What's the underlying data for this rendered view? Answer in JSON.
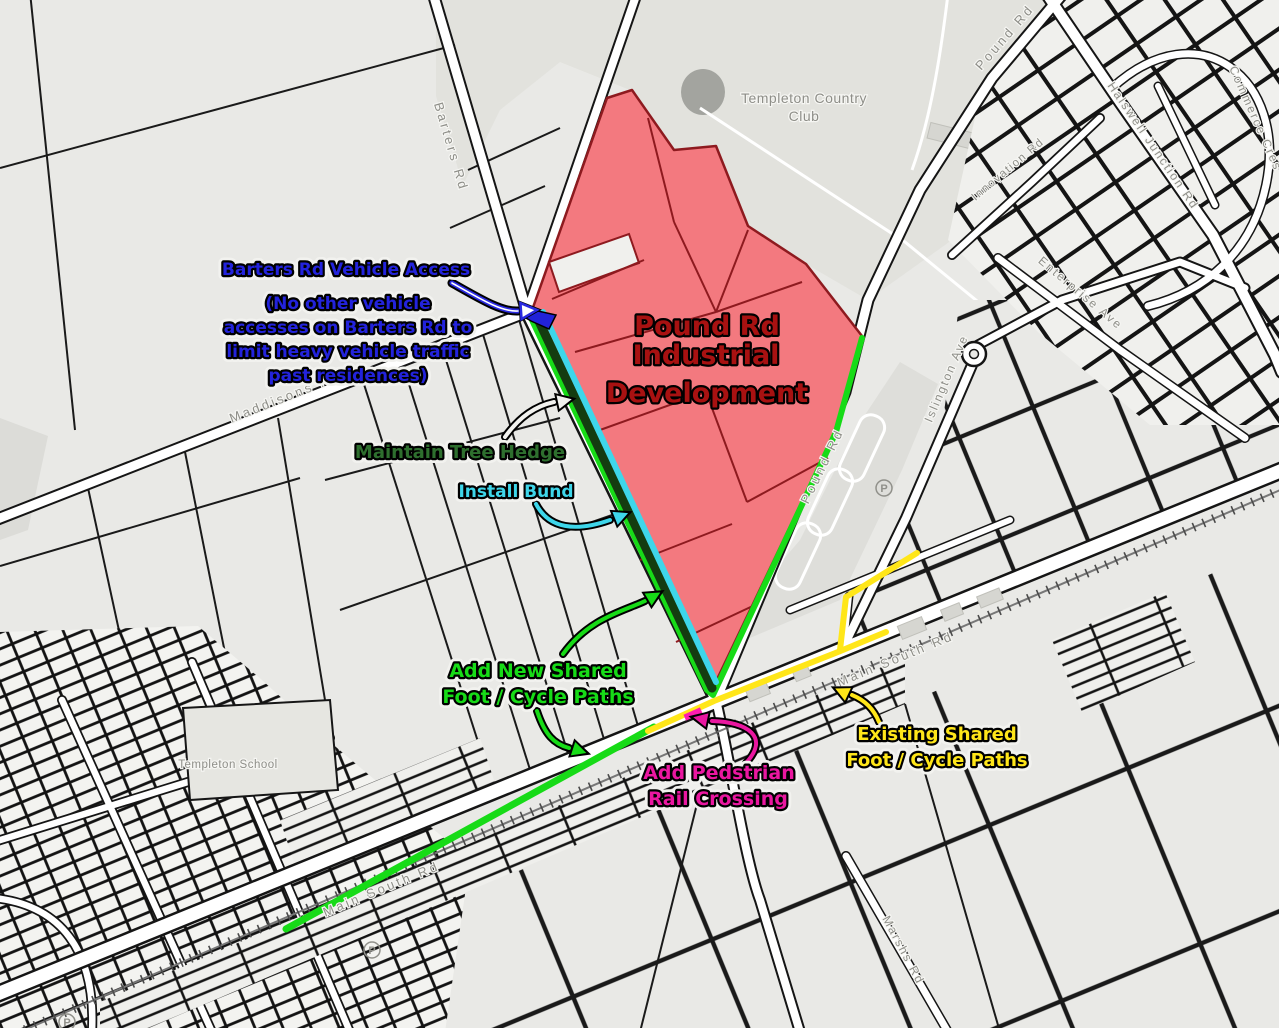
{
  "annotations": {
    "development_title_lines": [
      "Pound Rd",
      "Industrial",
      "Development"
    ],
    "access_title": "Barters Rd Vehicle Access",
    "access_note_lines": [
      "(No other vehicle",
      "accesses on Barters Rd to",
      "limit heavy vehicle traffic",
      "past residences)"
    ],
    "hedge_label": "Maintain Tree Hedge",
    "bund_label": "Install Bund",
    "new_paths_lines": [
      "Add New Shared",
      "Foot / Cycle Paths"
    ],
    "crossing_lines": [
      "Add Pedstrian",
      "Rail Crossing"
    ],
    "existing_paths_lines": [
      "Existing Shared",
      "Foot / Cycle Paths"
    ]
  },
  "map_labels": {
    "country_club_lines": [
      "Templeton Country",
      "Club"
    ],
    "school": "Templeton School",
    "parking": "P",
    "roads": {
      "barters": "Barters Rd",
      "maddisons": "Maddisons Rd",
      "main_south_a": "Main South Rd",
      "main_south_b": "Main South Rd",
      "pound_a": "Pound Rd",
      "pound_b": "Pound Rd",
      "halswell_a": "Halswell Junction Rd",
      "islington": "Islington Ave",
      "commerce": "Commerce Cres",
      "innovation": "Innovation Rd",
      "enterprise": "Enterprise Ave",
      "marshs": "Marshs Rd"
    }
  },
  "colors": {
    "development_fill": "#f3797f",
    "development_border": "#8e1a1f",
    "development_title": "#a81111",
    "access_blue": "#2323dc",
    "hedge_text_green": "#2e6f2e",
    "hedge_line_green": "#143c10",
    "bund_cyan": "#3ed6ea",
    "path_green": "#17db17",
    "path_yellow": "#ffe619",
    "crossing_magenta": "#ea17a0"
  }
}
